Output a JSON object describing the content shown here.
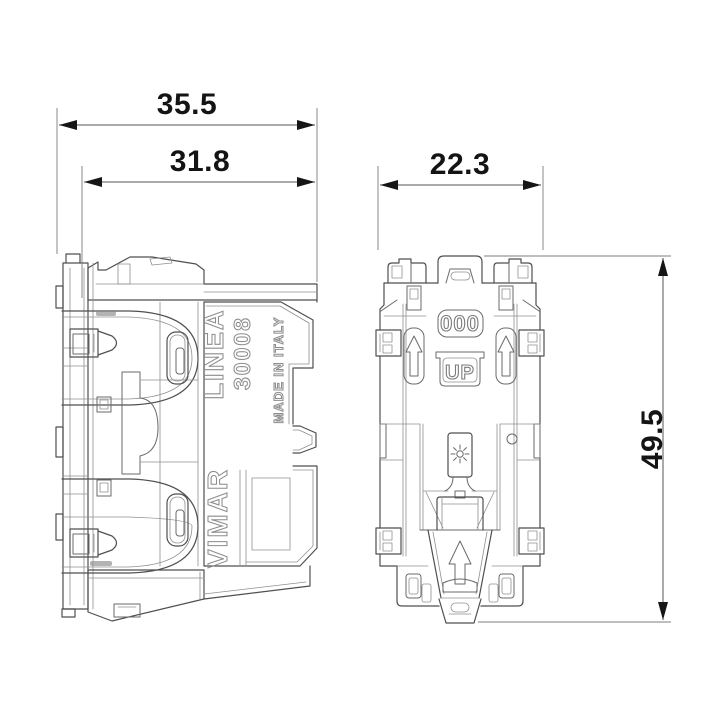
{
  "drawing": {
    "type": "technical-dimension-drawing",
    "dimensions": {
      "overall_depth_mm": "35.5",
      "recess_depth_mm": "31.8",
      "width_mm": "22.3",
      "height_mm": "49.5"
    },
    "side_view": {
      "series": "LINEA",
      "model": "30008",
      "origin": "MADE IN ITALY",
      "brand": "VIMAR"
    },
    "front_view": {
      "top_marking": "000",
      "orientation_marking": "UP"
    },
    "colors": {
      "line": "#4f4f4f",
      "engraving": "#8d8d8d",
      "dimension_text": "#141414",
      "background": "#ffffff"
    }
  }
}
